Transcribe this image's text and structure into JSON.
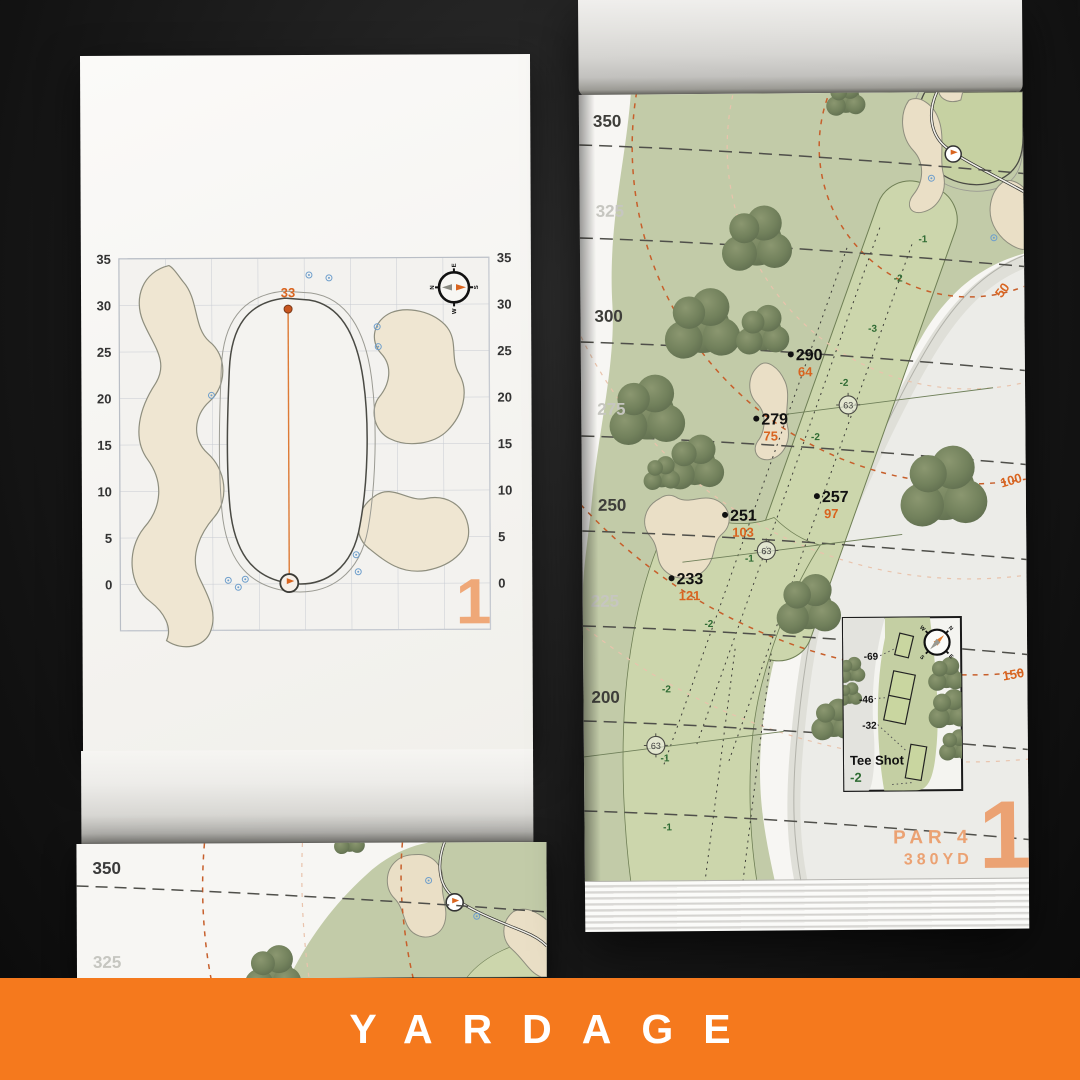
{
  "banner": {
    "label": "YARDAGE",
    "background": "#F5791D"
  },
  "colors": {
    "accent_orange": "#D9641F",
    "soft_orange": "#EBA273",
    "elevation_green": "#2F6B33",
    "rough_green": "#C2CBA8",
    "fairway_green": "#CCD6AC",
    "sand": "#EADFC6",
    "tree_green": "#6F7D5D",
    "paper": "#F7F6F3"
  },
  "left_page": {
    "hole_number": "1",
    "pin_distance": "33",
    "axis_labels": [
      "35",
      "30",
      "25",
      "20",
      "15",
      "10",
      "5",
      "0"
    ],
    "compass": {
      "n": "N",
      "e": "E",
      "s": "S",
      "w": "W"
    }
  },
  "right_page": {
    "hole_number": "1",
    "par_label": "PAR 4",
    "distance_label": "380YD",
    "distance_lines": [
      {
        "label": "350",
        "strong": true
      },
      {
        "label": "325",
        "strong": false
      },
      {
        "label": "300",
        "strong": true
      },
      {
        "label": "275",
        "strong": false
      },
      {
        "label": "250",
        "strong": true
      },
      {
        "label": "225",
        "strong": false
      },
      {
        "label": "200",
        "strong": true
      }
    ],
    "arc_labels": [
      "50",
      "100",
      "150"
    ],
    "markers": [
      {
        "carry": "290",
        "remaining": "64"
      },
      {
        "carry": "279",
        "remaining": "75"
      },
      {
        "carry": "257",
        "remaining": "97"
      },
      {
        "carry": "251",
        "remaining": "103"
      },
      {
        "carry": "233",
        "remaining": "121"
      }
    ],
    "elevations": [
      "-1",
      "-2",
      "-3",
      "-2",
      "-2",
      "-1",
      "-2",
      "-2",
      "-1",
      "-1"
    ],
    "pin_circles": [
      "63",
      "63",
      "63"
    ],
    "tee_inset": {
      "title": "Tee Shot",
      "elevation": "-2",
      "tees": [
        "-69",
        "-46",
        "-32"
      ],
      "compass": {
        "n": "N",
        "e": "E",
        "s": "S",
        "w": "W"
      }
    }
  },
  "bottom_page": {
    "distance_lines": [
      {
        "label": "350",
        "strong": true
      },
      {
        "label": "325",
        "strong": false
      }
    ]
  }
}
